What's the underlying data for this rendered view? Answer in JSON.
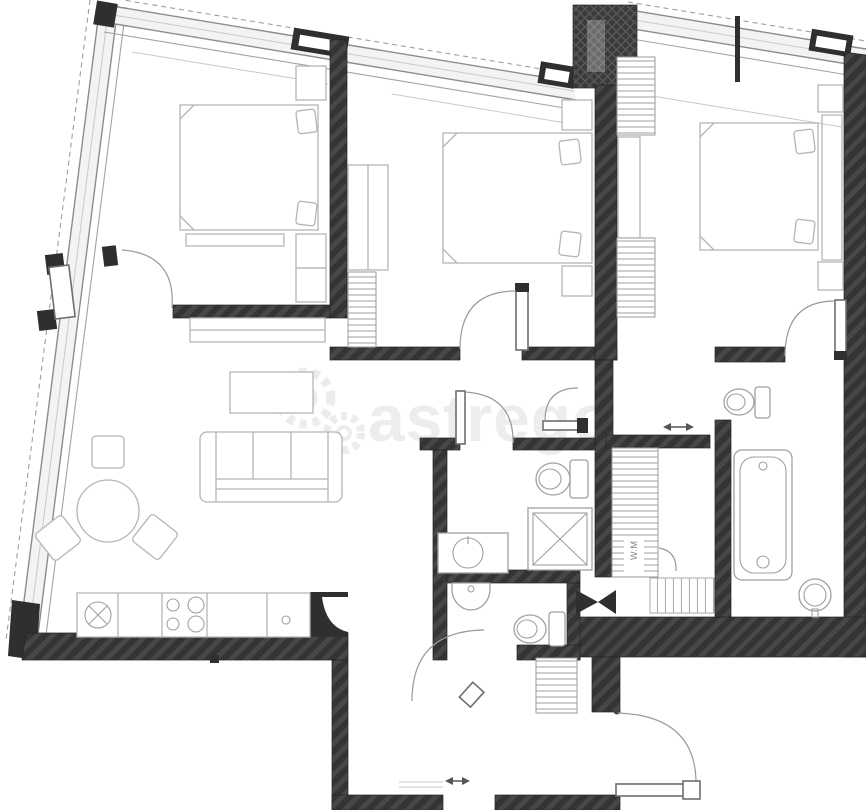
{
  "watermark": {
    "brand": "astrego",
    "icon": "gears-icon"
  },
  "labels": {
    "washing_machine": "W.M"
  },
  "palette": {
    "background": "#ffffff",
    "wall_fill": "#333333",
    "wall_hatch_line": "#4a4a4a",
    "glazing_fill": "#f3f3f3",
    "glazing_line": "#8c8c8c",
    "furniture_line": "#b5b5b5",
    "fixture_line": "#a0a0a0",
    "door_arc": "#9a9a9a",
    "slide_arrow": "#555555",
    "watermark_text": "#eeecec",
    "watermark_label": "#808080"
  }
}
